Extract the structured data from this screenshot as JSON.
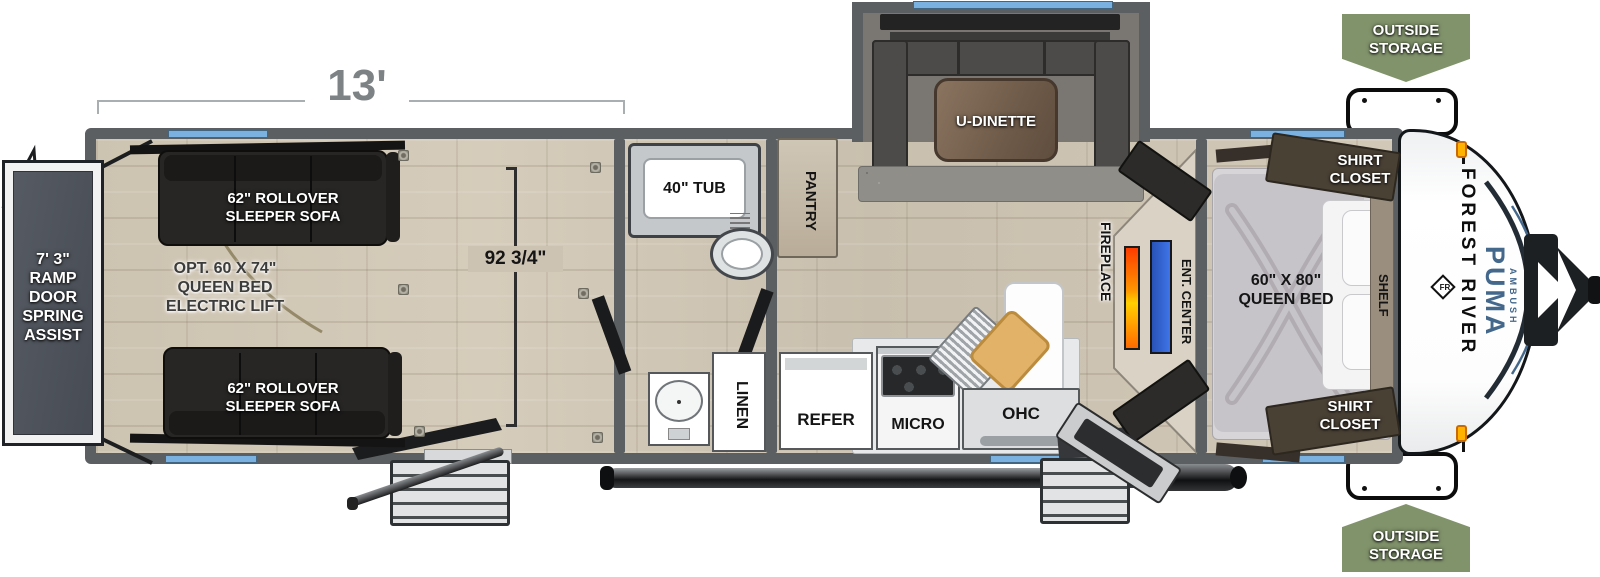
{
  "title": "Travel trailer floorplan",
  "dimensions": {
    "garage_length": "13'",
    "garage_width": "92 3/4\""
  },
  "brand": {
    "maker": "FOREST RIVER",
    "maker_logo": "FR",
    "model": "PUMA",
    "series": "AMBUSH"
  },
  "labels": {
    "ramp_door": [
      "7' 3\"",
      "RAMP DOOR",
      "SPRING",
      "ASSIST"
    ],
    "sofa_top": [
      "62\" ROLLOVER",
      "SLEEPER SOFA"
    ],
    "sofa_bottom": [
      "62\" ROLLOVER",
      "SLEEPER SOFA"
    ],
    "opt_bed": [
      "OPT. 60 X 74\"",
      "QUEEN BED",
      "ELECTRIC LIFT"
    ],
    "tub": "40\" TUB",
    "linen": "LINEN",
    "pantry": "PANTRY",
    "refer": "REFER",
    "micro": "MICRO",
    "ohc": "OHC",
    "u_dinette": "U-DINETTE",
    "fireplace": "FIREPLACE",
    "ent_center": "ENT. CENTER",
    "queen_bed": [
      "60\" X 80\"",
      "QUEEN BED"
    ],
    "shirt_closet_top": [
      "SHIRT",
      "CLOSET"
    ],
    "shirt_closet_bottom": [
      "SHIRT",
      "CLOSET"
    ],
    "shelf": "SHELF",
    "outside_storage_top": [
      "OUTSIDE",
      "STORAGE"
    ],
    "outside_storage_bottom": [
      "OUTSIDE",
      "STORAGE"
    ]
  },
  "colors": {
    "badge_green": "#81936b",
    "window_blue": "#7ab1e0",
    "wall_gray": "#5b5f61",
    "floor_beige": "#cec4b3",
    "fireplace_orange": "#ff7a00",
    "tv_blue": "#3566cf",
    "puma_blue": "#44688c",
    "marker_light_orange": "#ffb300"
  }
}
